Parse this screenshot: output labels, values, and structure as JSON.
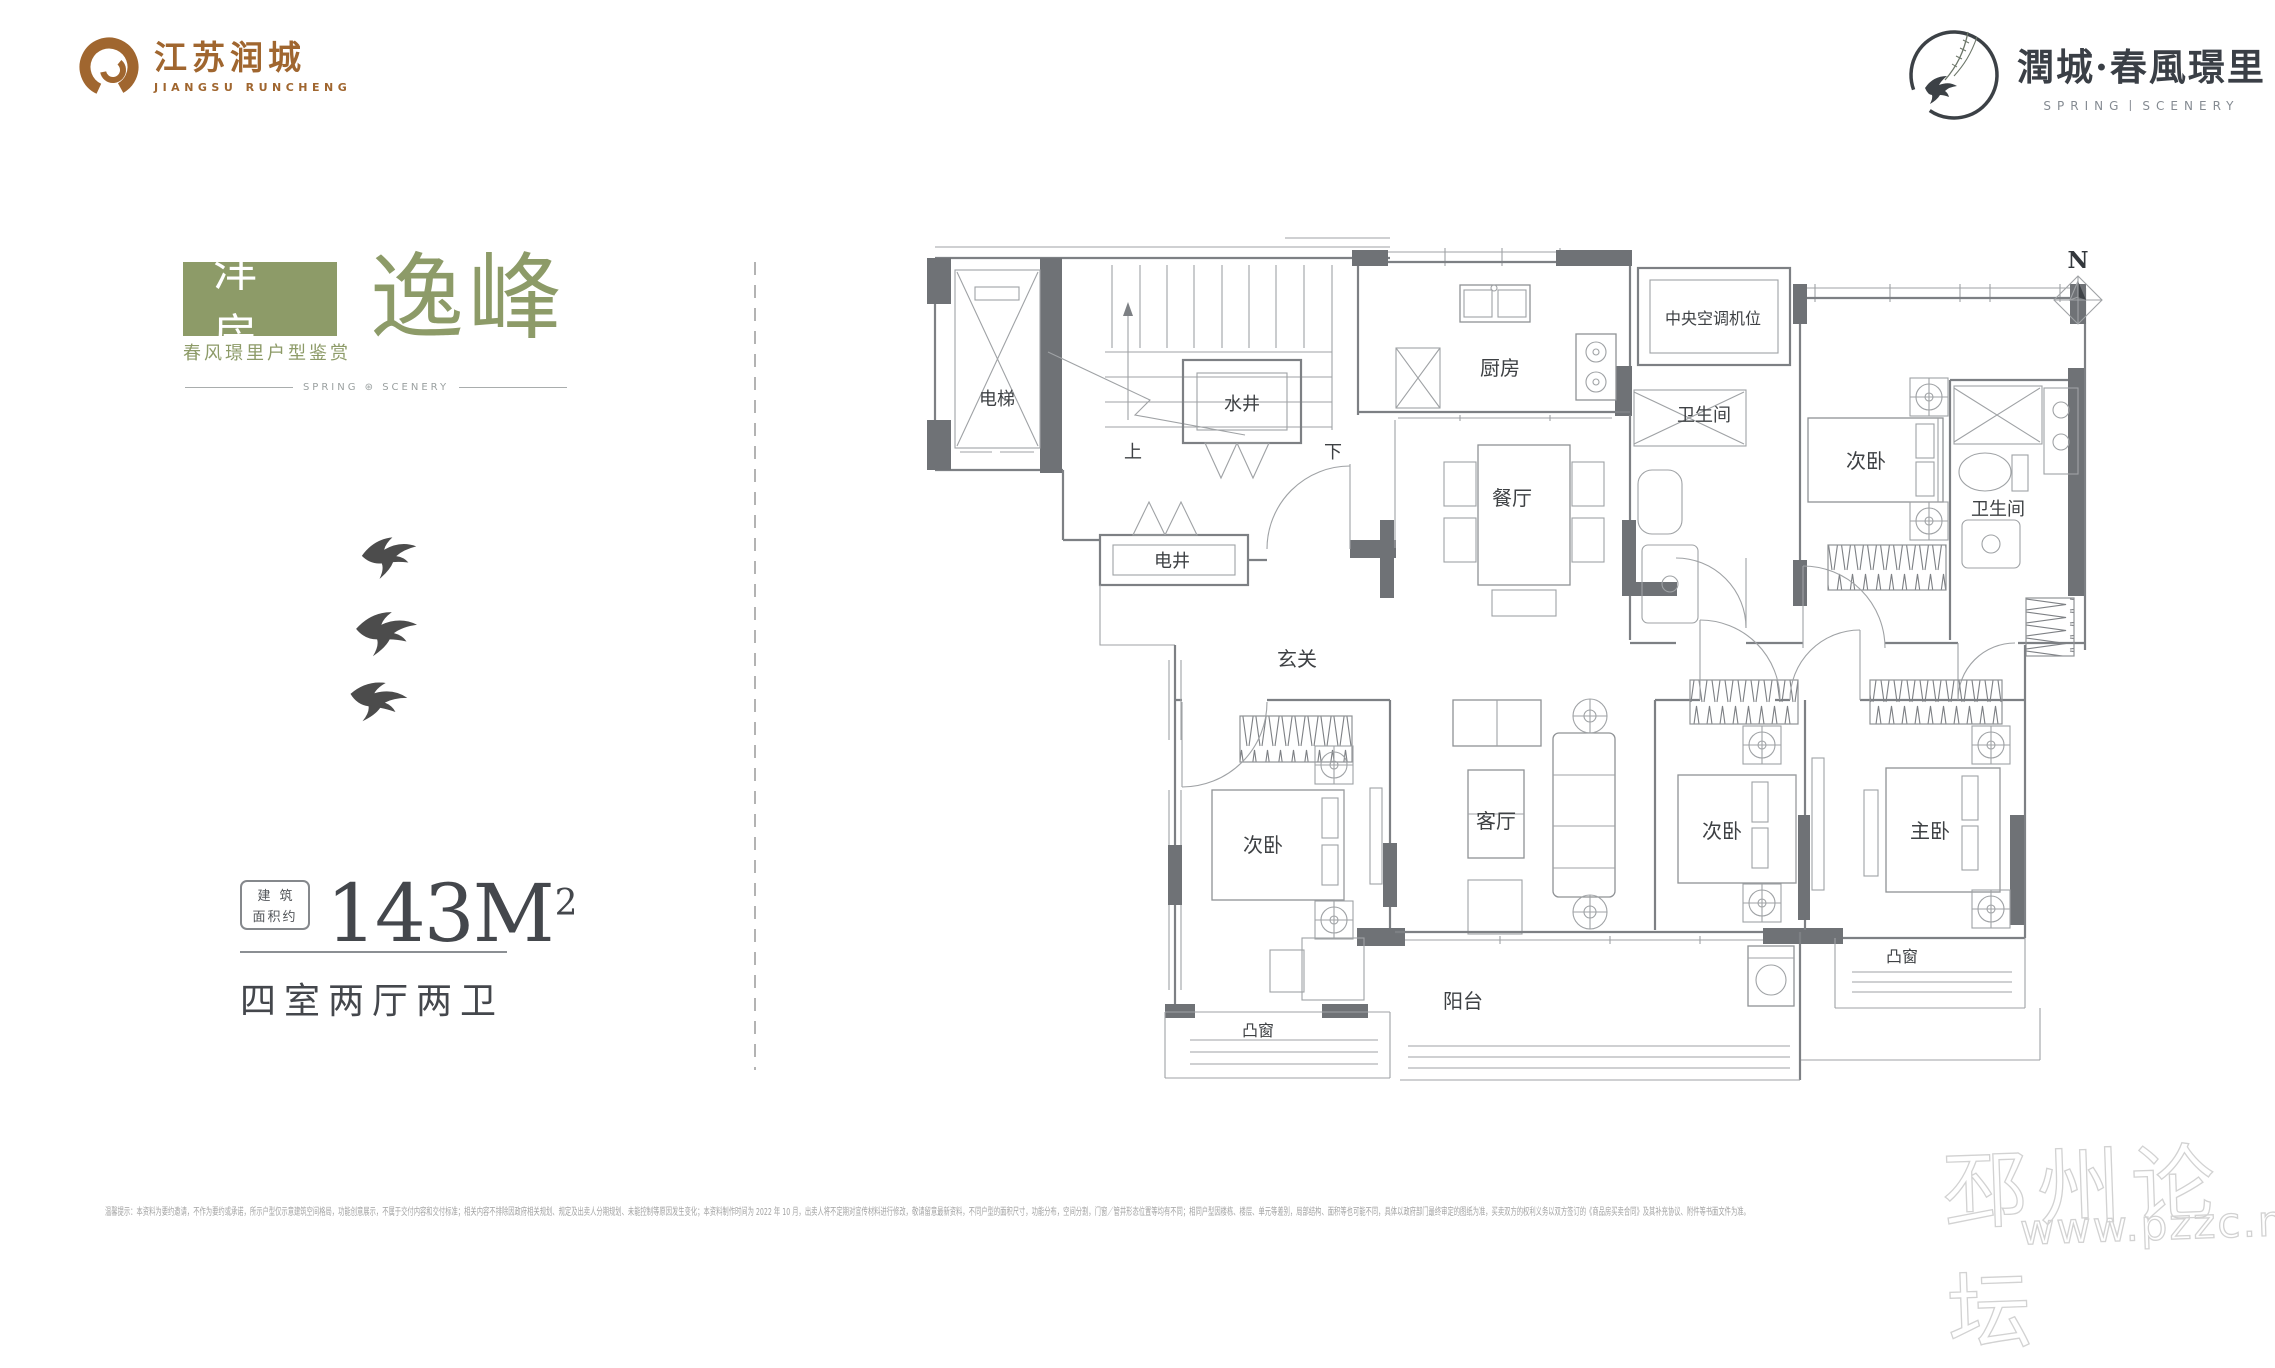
{
  "header": {
    "left_logo": {
      "cn": "江苏润城",
      "en": "JIANGSU RUNCHENG"
    },
    "right_logo": {
      "cn": "潤城·春風璟里",
      "en": "SPRING丨SCENERY"
    }
  },
  "left_panel": {
    "badge": "洋房",
    "title": "逸峰",
    "subtitle": "春风璟里户型鉴赏",
    "divider_text": "SPRING ⊛ SCENERY",
    "area_box_line1": "建筑",
    "area_box_line2": "面积约",
    "area_value": "143M",
    "area_sup": "2",
    "layout": "四室两厅两卫"
  },
  "floor_plan": {
    "compass": "N",
    "stair_up": "上",
    "stair_down": "下",
    "rooms": [
      {
        "label": "电梯"
      },
      {
        "label": "水井"
      },
      {
        "label": "厨房"
      },
      {
        "label": "中央空调机位"
      },
      {
        "label": "卫生间"
      },
      {
        "label": "次卧"
      },
      {
        "label": "卫生间"
      },
      {
        "label": "餐厅"
      },
      {
        "label": "电井"
      },
      {
        "label": "玄关"
      },
      {
        "label": "次卧"
      },
      {
        "label": "客厅"
      },
      {
        "label": "次卧"
      },
      {
        "label": "主卧"
      },
      {
        "label": "凸窗"
      },
      {
        "label": "阳台"
      },
      {
        "label": "凸窗"
      }
    ]
  },
  "footer": {
    "disclaimer": "温馨提示：本资料为要约邀请，不作为要约或承诺，所示户型仅示意建筑空间格局，功能创意展示，不属于交付内容和交付标准；相关内容不排除因政府相关规划、规定及出卖人分期规划、未能控制等原因发生变化；本资料制作时间为 2022 年 10 月，出卖人将不定期对宣传材料进行修改，敬请留意最新资料，不同户型的面积尺寸，功能分布，空间分割，门窗／管井形态位置等均有不同；相同户型因楼栋、楼层、单元等差别，局部结构、面积等也可能不同，具体以政府部门最终审定的图纸为准，买卖双方的权利义务以双方签订的《商品房买卖合同》及其补充协议、附件等书面文件为准。"
  },
  "watermark": {
    "line1": "邳州论坛",
    "line2": "www.pzzc.net"
  },
  "colors": {
    "brand_brown": "#a0662f",
    "sage_green": "#8d9b68",
    "ink": "#3a3f46",
    "wall_gray": "#6f7276"
  }
}
